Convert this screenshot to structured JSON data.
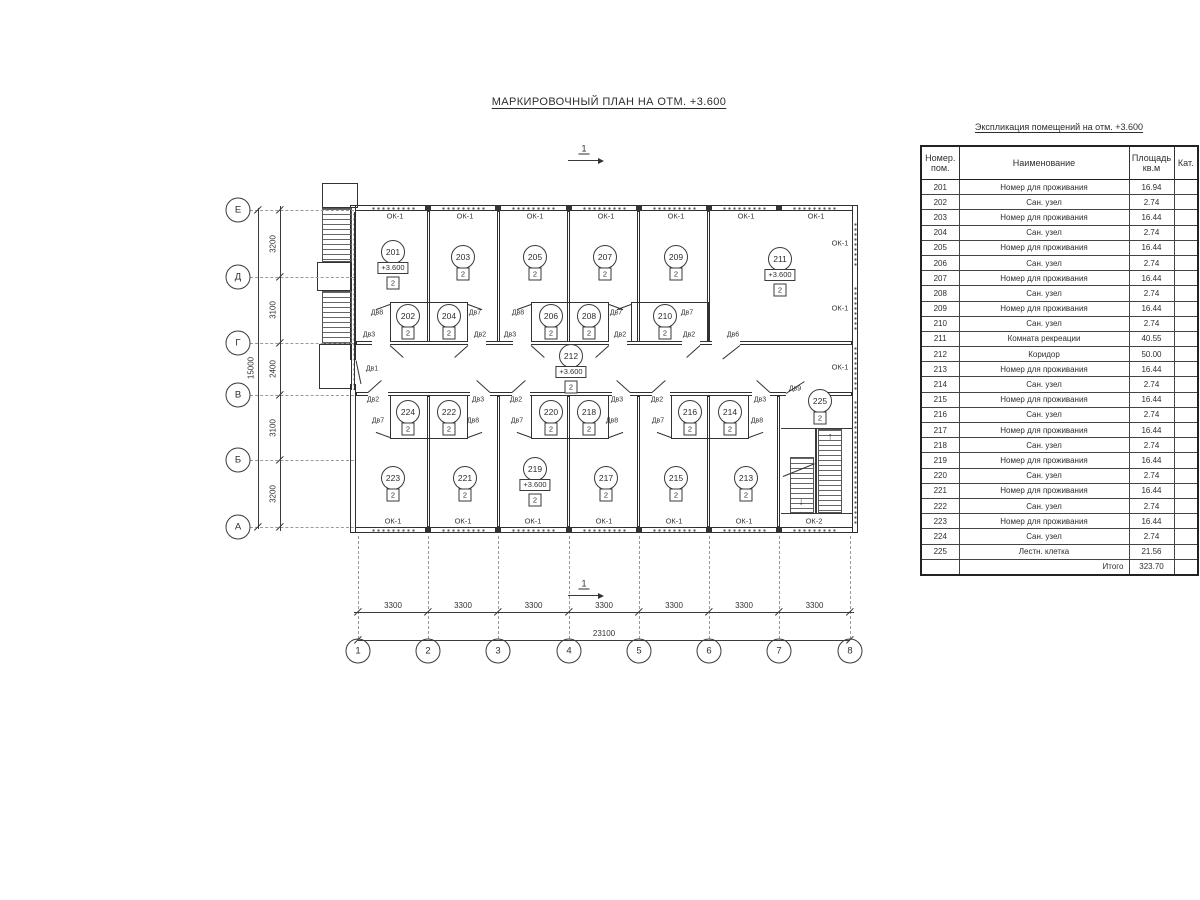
{
  "title": "МАРКИРОВОЧНЫЙ ПЛАН НА ОТМ. +3.600",
  "table": {
    "title": "Экспликация помещений на отм. +3.600",
    "headers": {
      "num": "Номер.\nпом.",
      "name": "Наименование",
      "area": "Площадь\nкв.м",
      "cat": "Кат."
    },
    "rows": [
      [
        "201",
        "Номер для проживания",
        "16.94",
        ""
      ],
      [
        "202",
        "Сан. узел",
        "2.74",
        ""
      ],
      [
        "203",
        "Номер для проживания",
        "16.44",
        ""
      ],
      [
        "204",
        "Сан. узел",
        "2.74",
        ""
      ],
      [
        "205",
        "Номер для проживания",
        "16.44",
        ""
      ],
      [
        "206",
        "Сан. узел",
        "2.74",
        ""
      ],
      [
        "207",
        "Номер для проживания",
        "16.44",
        ""
      ],
      [
        "208",
        "Сан. узел",
        "2.74",
        ""
      ],
      [
        "209",
        "Номер для проживания",
        "16.44",
        ""
      ],
      [
        "210",
        "Сан. узел",
        "2.74",
        ""
      ],
      [
        "211",
        "Комната рекреации",
        "40.55",
        ""
      ],
      [
        "212",
        "Коридор",
        "50.00",
        ""
      ],
      [
        "213",
        "Номер для проживания",
        "16.44",
        ""
      ],
      [
        "214",
        "Сан. узел",
        "2.74",
        ""
      ],
      [
        "215",
        "Номер для проживания",
        "16.44",
        ""
      ],
      [
        "216",
        "Сан. узел",
        "2.74",
        ""
      ],
      [
        "217",
        "Номер для проживания",
        "16.44",
        ""
      ],
      [
        "218",
        "Сан. узел",
        "2.74",
        ""
      ],
      [
        "219",
        "Номер для проживания",
        "16.44",
        ""
      ],
      [
        "220",
        "Сан. узел",
        "2.74",
        ""
      ],
      [
        "221",
        "Номер для проживания",
        "16.44",
        ""
      ],
      [
        "222",
        "Сан. узел",
        "2.74",
        ""
      ],
      [
        "223",
        "Номер для проживания",
        "16.44",
        ""
      ],
      [
        "224",
        "Сан. узел",
        "2.74",
        ""
      ],
      [
        "225",
        "Лестн. клетка",
        "21.56",
        ""
      ]
    ],
    "total_label": "Итого",
    "total_value": "323.70"
  },
  "plan": {
    "elevation_mark": "+3.600",
    "rooms": [
      {
        "n": "201",
        "x": 393,
        "y": 252,
        "elev": "+3.600",
        "cat": "2"
      },
      {
        "n": "202",
        "x": 408,
        "y": 316,
        "cat": "2"
      },
      {
        "n": "203",
        "x": 463,
        "y": 257,
        "cat": "2"
      },
      {
        "n": "204",
        "x": 449,
        "y": 316,
        "cat": "2"
      },
      {
        "n": "205",
        "x": 535,
        "y": 257,
        "cat": "2"
      },
      {
        "n": "206",
        "x": 551,
        "y": 316,
        "cat": "2"
      },
      {
        "n": "207",
        "x": 605,
        "y": 257,
        "cat": "2"
      },
      {
        "n": "208",
        "x": 589,
        "y": 316,
        "cat": "2"
      },
      {
        "n": "209",
        "x": 676,
        "y": 257,
        "cat": "2"
      },
      {
        "n": "210",
        "x": 665,
        "y": 316,
        "cat": "2"
      },
      {
        "n": "211",
        "x": 780,
        "y": 259,
        "elev": "+3.600",
        "cat": "2"
      },
      {
        "n": "212",
        "x": 571,
        "y": 356,
        "elev": "+3.600",
        "cat": "2"
      },
      {
        "n": "213",
        "x": 746,
        "y": 478,
        "cat": "2"
      },
      {
        "n": "214",
        "x": 730,
        "y": 412,
        "cat": "2"
      },
      {
        "n": "215",
        "x": 676,
        "y": 478,
        "cat": "2"
      },
      {
        "n": "216",
        "x": 690,
        "y": 412,
        "cat": "2"
      },
      {
        "n": "217",
        "x": 606,
        "y": 478,
        "cat": "2"
      },
      {
        "n": "218",
        "x": 589,
        "y": 412,
        "cat": "2"
      },
      {
        "n": "219",
        "x": 535,
        "y": 469,
        "elev": "+3.600",
        "cat": "2"
      },
      {
        "n": "220",
        "x": 551,
        "y": 412,
        "cat": "2"
      },
      {
        "n": "221",
        "x": 465,
        "y": 478,
        "cat": "2"
      },
      {
        "n": "222",
        "x": 449,
        "y": 412,
        "cat": "2"
      },
      {
        "n": "223",
        "x": 393,
        "y": 478,
        "cat": "2"
      },
      {
        "n": "224",
        "x": 408,
        "y": 412,
        "cat": "2"
      },
      {
        "n": "225",
        "x": 820,
        "y": 401,
        "cat": "2"
      }
    ],
    "axes_left": [
      {
        "label": "Е",
        "y": 210
      },
      {
        "label": "Д",
        "y": 277
      },
      {
        "label": "Г",
        "y": 343
      },
      {
        "label": "В",
        "y": 395
      },
      {
        "label": "Б",
        "y": 460
      },
      {
        "label": "А",
        "y": 527
      }
    ],
    "axes_bottom": [
      {
        "label": "1",
        "x": 358
      },
      {
        "label": "2",
        "x": 428
      },
      {
        "label": "3",
        "x": 498
      },
      {
        "label": "4",
        "x": 569
      },
      {
        "label": "5",
        "x": 639
      },
      {
        "label": "6",
        "x": 709
      },
      {
        "label": "7",
        "x": 779
      },
      {
        "label": "8",
        "x": 850
      }
    ],
    "dims_left": {
      "segments": [
        "3200",
        "3100",
        "2400",
        "3100",
        "3200"
      ],
      "total": "15000"
    },
    "dims_bottom": {
      "segments": [
        "3300",
        "3300",
        "3300",
        "3300",
        "3300",
        "3300",
        "3300"
      ],
      "total": "23100"
    },
    "window_labels": [
      {
        "t": "ОК-1",
        "x": 395,
        "y": 216
      },
      {
        "t": "ОК-1",
        "x": 465,
        "y": 216
      },
      {
        "t": "ОК-1",
        "x": 535,
        "y": 216
      },
      {
        "t": "ОК-1",
        "x": 606,
        "y": 216
      },
      {
        "t": "ОК-1",
        "x": 676,
        "y": 216
      },
      {
        "t": "ОК-1",
        "x": 746,
        "y": 216
      },
      {
        "t": "ОК-1",
        "x": 816,
        "y": 216
      },
      {
        "t": "ОК-1",
        "x": 840,
        "y": 243
      },
      {
        "t": "ОК-1",
        "x": 840,
        "y": 308
      },
      {
        "t": "ОК-1",
        "x": 840,
        "y": 367
      },
      {
        "t": "ОК-1",
        "x": 393,
        "y": 521
      },
      {
        "t": "ОК-1",
        "x": 463,
        "y": 521
      },
      {
        "t": "ОК-1",
        "x": 533,
        "y": 521
      },
      {
        "t": "ОК-1",
        "x": 604,
        "y": 521
      },
      {
        "t": "ОК-1",
        "x": 674,
        "y": 521
      },
      {
        "t": "ОК-1",
        "x": 744,
        "y": 521
      },
      {
        "t": "ОК-2",
        "x": 814,
        "y": 521
      }
    ],
    "door_labels": [
      {
        "t": "Дв8",
        "x": 377,
        "y": 313
      },
      {
        "t": "Дв7",
        "x": 475,
        "y": 313
      },
      {
        "t": "Дв3",
        "x": 369,
        "y": 335
      },
      {
        "t": "Дв2",
        "x": 480,
        "y": 335
      },
      {
        "t": "Дв8",
        "x": 518,
        "y": 313
      },
      {
        "t": "Дв7",
        "x": 616,
        "y": 313
      },
      {
        "t": "Дв3",
        "x": 510,
        "y": 335
      },
      {
        "t": "Дв2",
        "x": 620,
        "y": 335
      },
      {
        "t": "Дв7",
        "x": 687,
        "y": 313
      },
      {
        "t": "Дв2",
        "x": 689,
        "y": 335
      },
      {
        "t": "Дв6",
        "x": 733,
        "y": 335
      },
      {
        "t": "Дв1",
        "x": 372,
        "y": 369
      },
      {
        "t": "Дв2",
        "x": 373,
        "y": 400
      },
      {
        "t": "Дв3",
        "x": 478,
        "y": 400
      },
      {
        "t": "Дв7",
        "x": 378,
        "y": 421
      },
      {
        "t": "Дв8",
        "x": 473,
        "y": 421
      },
      {
        "t": "Дв2",
        "x": 516,
        "y": 400
      },
      {
        "t": "Дв3",
        "x": 617,
        "y": 400
      },
      {
        "t": "Дв7",
        "x": 517,
        "y": 421
      },
      {
        "t": "Дв8",
        "x": 612,
        "y": 421
      },
      {
        "t": "Дв2",
        "x": 657,
        "y": 400
      },
      {
        "t": "Дв3",
        "x": 760,
        "y": 400
      },
      {
        "t": "Дв7",
        "x": 658,
        "y": 421
      },
      {
        "t": "Дв8",
        "x": 757,
        "y": 421
      },
      {
        "t": "Дв9",
        "x": 795,
        "y": 389
      }
    ],
    "section_marks": [
      {
        "label": "1",
        "x": 584,
        "y": 149
      },
      {
        "label": "1",
        "x": 584,
        "y": 584
      }
    ]
  }
}
